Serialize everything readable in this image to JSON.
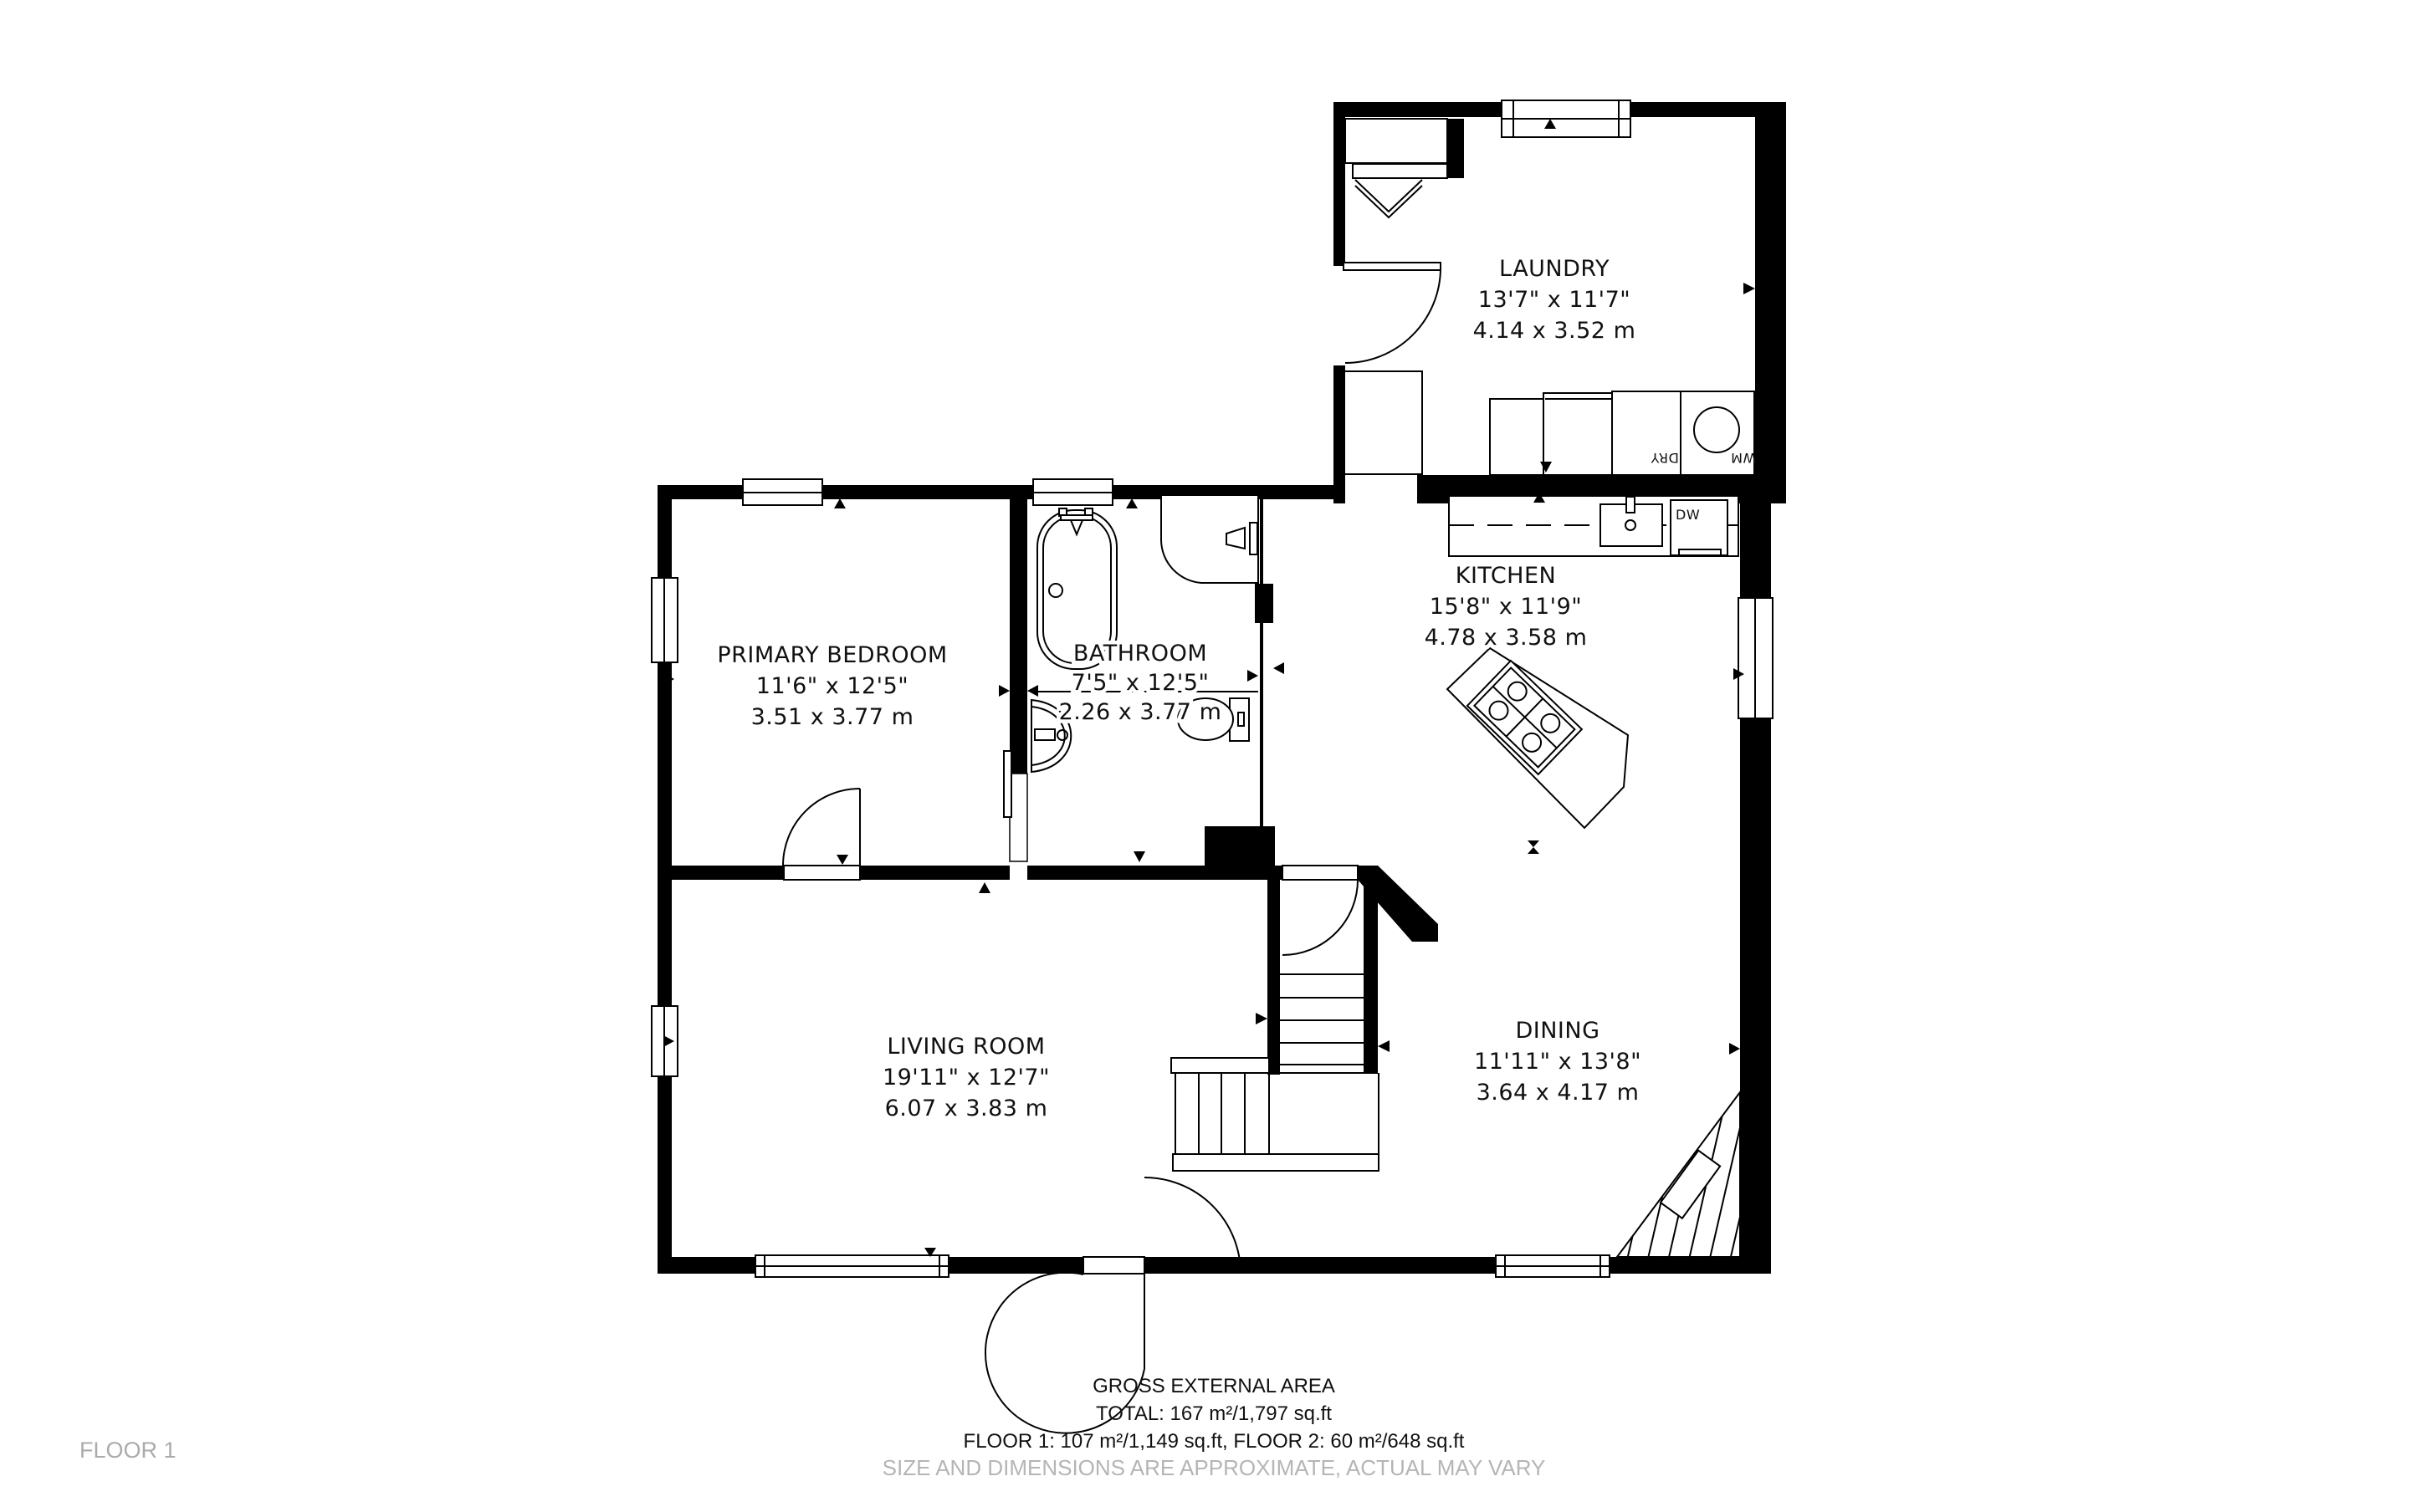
{
  "floor_label": "FLOOR 1",
  "footer": {
    "line1": "GROSS EXTERNAL AREA",
    "line2": "TOTAL: 167 m²/1,797 sq.ft",
    "line3": "FLOOR 1: 107 m²/1,149 sq.ft, FLOOR 2: 60 m²/648 sq.ft",
    "line4": "SIZE AND DIMENSIONS ARE APPROXIMATE, ACTUAL MAY VARY"
  },
  "rooms": {
    "laundry": {
      "name": "LAUNDRY",
      "imperial": "13'7\" x 11'7\"",
      "metric": "4.14 x 3.52 m"
    },
    "kitchen": {
      "name": "KITCHEN",
      "imperial": "15'8\" x 11'9\"",
      "metric": "4.78 x 3.58 m"
    },
    "primary_bedroom": {
      "name": "PRIMARY BEDROOM",
      "imperial": "11'6\" x 12'5\"",
      "metric": "3.51 x 3.77 m"
    },
    "bathroom": {
      "name": "BATHROOM",
      "imperial": "7'5\" x 12'5\"",
      "metric": "2.26 x 3.77 m"
    },
    "living_room": {
      "name": "LIVING ROOM",
      "imperial": "19'11\" x 12'7\"",
      "metric": "6.07 x 3.83 m"
    },
    "dining": {
      "name": "DINING",
      "imperial": "11'11\" x 13'8\"",
      "metric": "3.64 x 4.17 m"
    }
  },
  "appliances": {
    "dishwasher": "DW",
    "dryer": "DRY",
    "washer": "WM"
  },
  "colors": {
    "wall": "#000000",
    "muted_text": "#b5b5b5",
    "floor_text": "#ababab",
    "background": "#ffffff"
  }
}
